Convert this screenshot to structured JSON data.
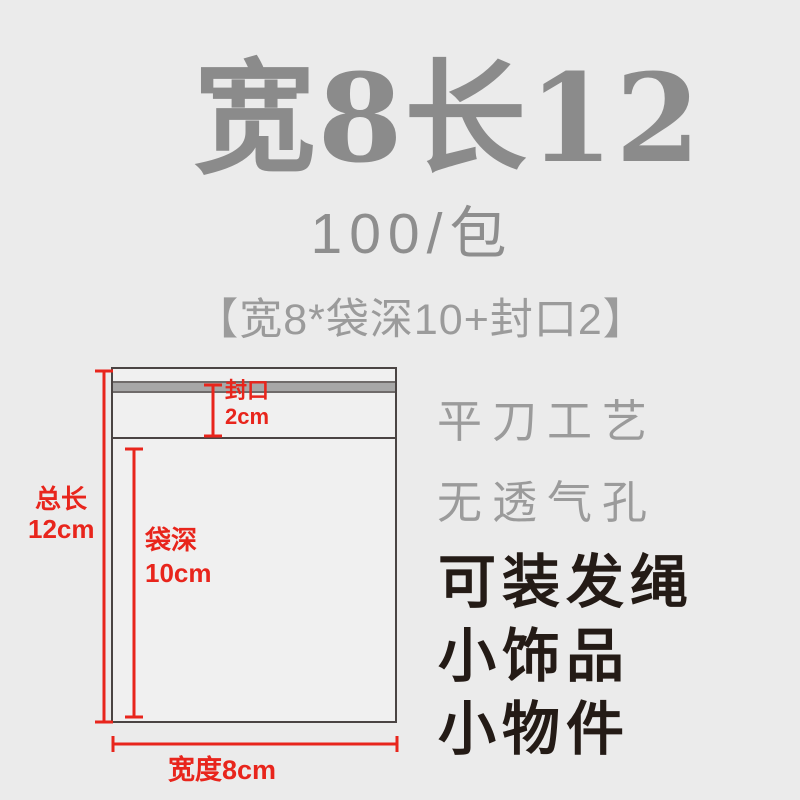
{
  "header": {
    "title": "宽8长12",
    "pack_quantity": "100/包",
    "spec": "【宽8*袋深10+封口2】"
  },
  "diagram": {
    "seal": {
      "label": "封口",
      "value": "2cm"
    },
    "total_length": {
      "label": "总长",
      "value": "12cm"
    },
    "bag_depth": {
      "label": "袋深",
      "value": "10cm"
    },
    "width": {
      "label": "宽度8cm"
    }
  },
  "features": {
    "craft": [
      "平刀工艺",
      "无透气孔"
    ],
    "uses": [
      "可装发绳",
      "小饰品",
      "小物件"
    ]
  },
  "colors": {
    "background": "#ebebeb",
    "title_gray": "#8b8b8b",
    "light_gray_text": "#9b9b9b",
    "black_text": "#241b16",
    "accent_red": "#e8251c",
    "bag_outline": "#4a4443",
    "seal_strip": "#a7a7a7"
  }
}
